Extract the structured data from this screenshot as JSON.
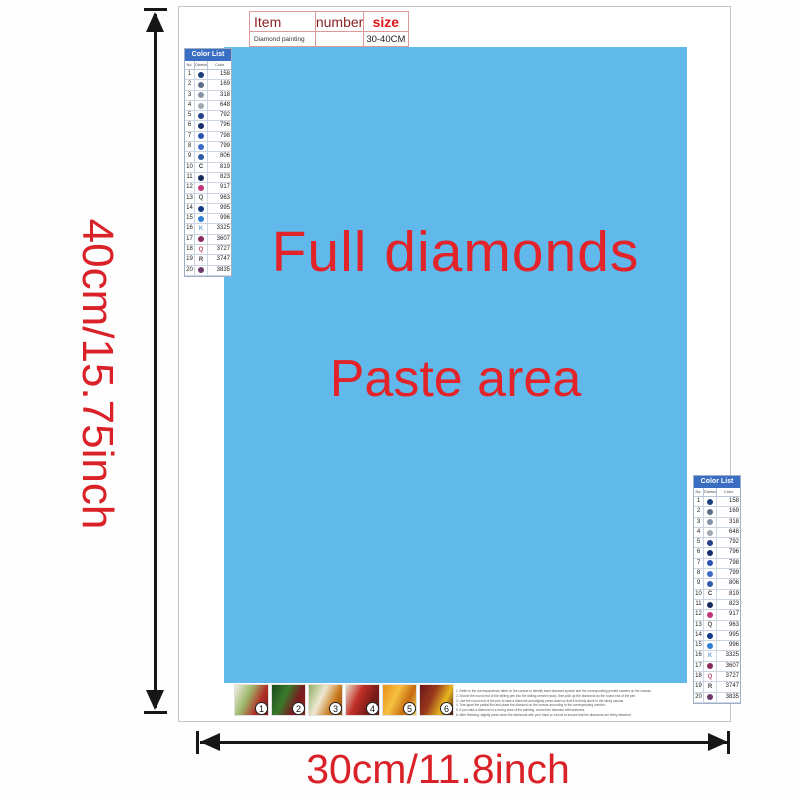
{
  "item_table": {
    "col_item": "Item",
    "col_number": "number",
    "col_size": "size",
    "row_item": "Diamond painting",
    "row_number": "",
    "row_size": "30-40CM"
  },
  "paste_area": {
    "line1": "Full diamonds",
    "line2": "Paste area"
  },
  "dimension_labels": {
    "height": "40cm/15.75inch",
    "width": "30cm/11.8inch"
  },
  "colors": {
    "paste_area_bg": "#60b8eb",
    "accent_red": "#d92127",
    "list_header_bg": "#3a6ec2",
    "arrow": "#161616"
  },
  "color_list": {
    "title": "Color List",
    "headers": {
      "no": "No.",
      "symbol": "Diamond",
      "color": "Color"
    },
    "rows": [
      {
        "no": "1",
        "code": "158",
        "symbol": "dot",
        "color": "#1c3f7e"
      },
      {
        "no": "2",
        "code": "169",
        "symbol": "dot",
        "color": "#5d6f86"
      },
      {
        "no": "3",
        "code": "318",
        "symbol": "dot",
        "color": "#8593a6"
      },
      {
        "no": "4",
        "code": "648",
        "symbol": "dot",
        "color": "#9fa8b0"
      },
      {
        "no": "5",
        "code": "792",
        "symbol": "dot",
        "color": "#24418c"
      },
      {
        "no": "6",
        "code": "796",
        "symbol": "dot",
        "color": "#16306e"
      },
      {
        "no": "7",
        "code": "798",
        "symbol": "dot",
        "color": "#2a52b0"
      },
      {
        "no": "8",
        "code": "799",
        "symbol": "dot",
        "color": "#3c6cc8"
      },
      {
        "no": "9",
        "code": "806",
        "symbol": "dot",
        "color": "#2e5ca8"
      },
      {
        "no": "10",
        "code": "819",
        "symbol": "letter",
        "char": "C",
        "color": "#333333"
      },
      {
        "no": "11",
        "code": "823",
        "symbol": "dot",
        "color": "#152a5e"
      },
      {
        "no": "12",
        "code": "917",
        "symbol": "dot",
        "color": "#c2337a"
      },
      {
        "no": "13",
        "code": "963",
        "symbol": "letter",
        "char": "Q",
        "color": "#555555"
      },
      {
        "no": "14",
        "code": "995",
        "symbol": "dot",
        "color": "#123a8a"
      },
      {
        "no": "15",
        "code": "996",
        "symbol": "dot",
        "color": "#2f7fd6"
      },
      {
        "no": "16",
        "code": "3325",
        "symbol": "letter",
        "char": "K",
        "color": "#6fa8d6"
      },
      {
        "no": "17",
        "code": "3607",
        "symbol": "dot",
        "color": "#8c2a5e"
      },
      {
        "no": "18",
        "code": "3727",
        "symbol": "letter",
        "char": "Q",
        "color": "#c04a6a"
      },
      {
        "no": "19",
        "code": "3747",
        "symbol": "letter",
        "char": "R",
        "color": "#444444"
      },
      {
        "no": "20",
        "code": "3835",
        "symbol": "dot",
        "color": "#6e3a6e"
      }
    ]
  },
  "steps": [
    {
      "number": "1",
      "colors": [
        "#f2efe6",
        "#9db86a",
        "#b23028",
        "#6e1d1d"
      ]
    },
    {
      "number": "2",
      "colors": [
        "#1d4a1f",
        "#3a7a2a",
        "#7a1a20",
        "#8a2a1e"
      ]
    },
    {
      "number": "3",
      "colors": [
        "#8fae62",
        "#efe8d2",
        "#c87a1e",
        "#8a4a12"
      ]
    },
    {
      "number": "4",
      "colors": [
        "#e9e0cf",
        "#c23028",
        "#7c1b18",
        "#55201a"
      ]
    },
    {
      "number": "5",
      "colors": [
        "#e89018",
        "#f5c040",
        "#c86a10",
        "#f0d860"
      ]
    },
    {
      "number": "6",
      "colors": [
        "#6a1518",
        "#9a3a1c",
        "#e8b820",
        "#481012"
      ]
    }
  ],
  "instructions": {
    "lines": [
      "1. Refer to the correspondence table on the canvas to identify each diamond symbol and the corresponding printed number on the canvas.",
      "2. Shovel the round end of the drilling pen into the drilling cement (wax), then pick up the diamonds by the round end of the pen.",
      "3. Use the round end of the pen to stick a diamond and slightly press down so that it is firmly stuck to the sticky canvas.",
      "4. Tear apart the partial film and place the diamond on the canvas according to the corresponding number.",
      "5. If you stick a diamond in a wrong area of the painting, correct the diamond with tweezers.",
      "6. After finishing, slightly press down the diamonds with your hand or a book to ensure that the diamonds are firmly attached."
    ]
  }
}
